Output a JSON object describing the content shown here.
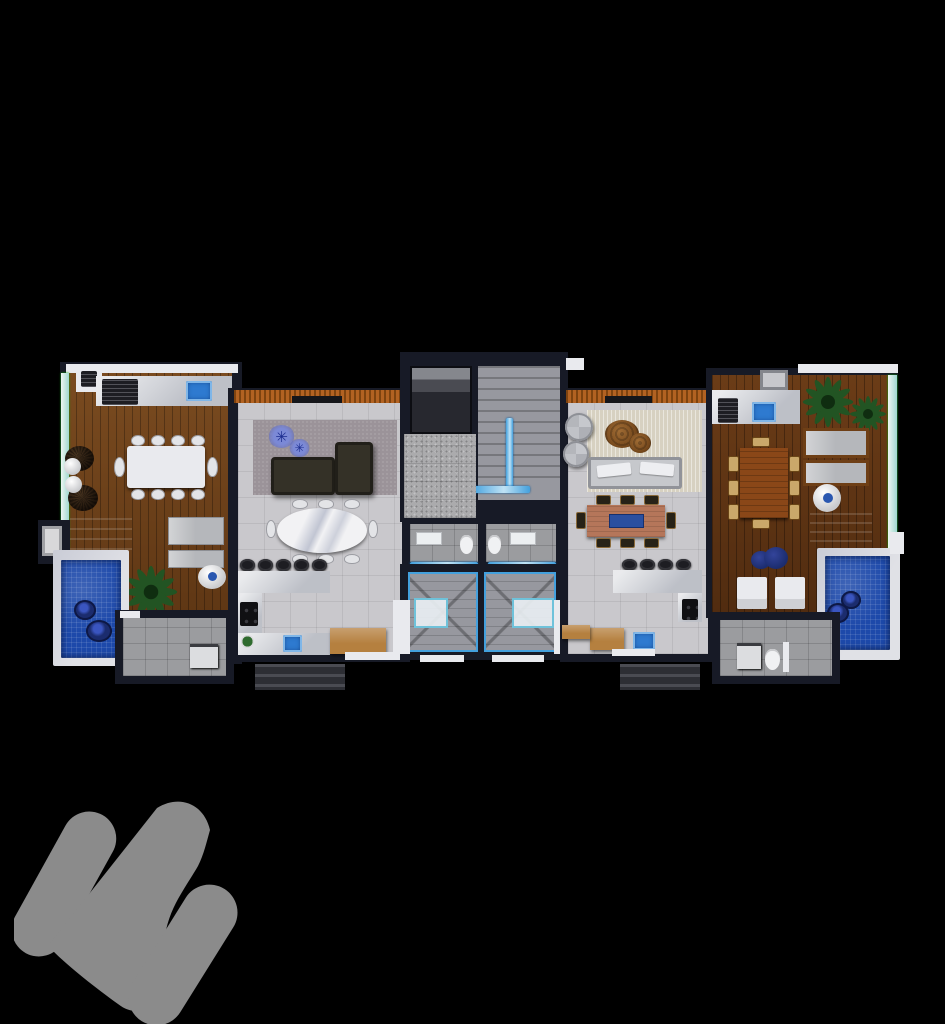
{
  "scene": {
    "type": "architectural-floor-plan-render",
    "view": "top-down 3D dollhouse render",
    "background": "#000000",
    "description": "Two mirrored duplex penthouse units with private wood-deck terraces and plunge pools flanking a central elevator and stair core"
  },
  "palette": {
    "bg": "#000000",
    "wall": "#171a26",
    "floor": "#c9c8cc",
    "marble": "#d4d6db",
    "white": "#e9eaee",
    "glass": "#9fd8cf",
    "pool": "#1d49aa",
    "poolBorder": "#e0e1e6",
    "blue": "#2e7ad0",
    "railing": "#43a0dd",
    "pergola": "#b26222",
    "rugL": "#9b9399",
    "rugR": "#d7d1c1",
    "sofaL": "#343127",
    "sofaR": "#c6c8cc",
    "stairs": "#97989f",
    "granite": "#ababad",
    "tileGray": "#9b9c9f",
    "palm": "#225423",
    "floatNavy": "#1b2c6e",
    "stool": "#1d1d22",
    "chairTan": "#caa86a",
    "tableR": "#b5765a",
    "terrTable": "#8a4718",
    "woodFurn": "#b5803f",
    "logo": "#8b8b8b"
  },
  "icons": {
    "flower_glyph": "✳"
  },
  "watermark": {
    "label": "Developer logo watermark",
    "color": "#8b8b8b",
    "shape": "three rounded diagonal bars forming a stylized monogram"
  },
  "left_unit": {
    "label": "Left unit — terrace with BBQ counter, 10-seat dining table, loungers, plunge pool; living room with L-sofa, oval 8-seat dining table, open kitchen; service room"
  },
  "core": {
    "label": "Central core — elevator, common stair with glass rail, two lavatories, two private winder stairs"
  },
  "right_unit": {
    "label": "Right unit — living room with round armchairs, white sofa, 8-seat wood dining table, open kitchen; terrace with BBQ counter, 8-seat table, loungers, plunge pool; bathroom"
  }
}
